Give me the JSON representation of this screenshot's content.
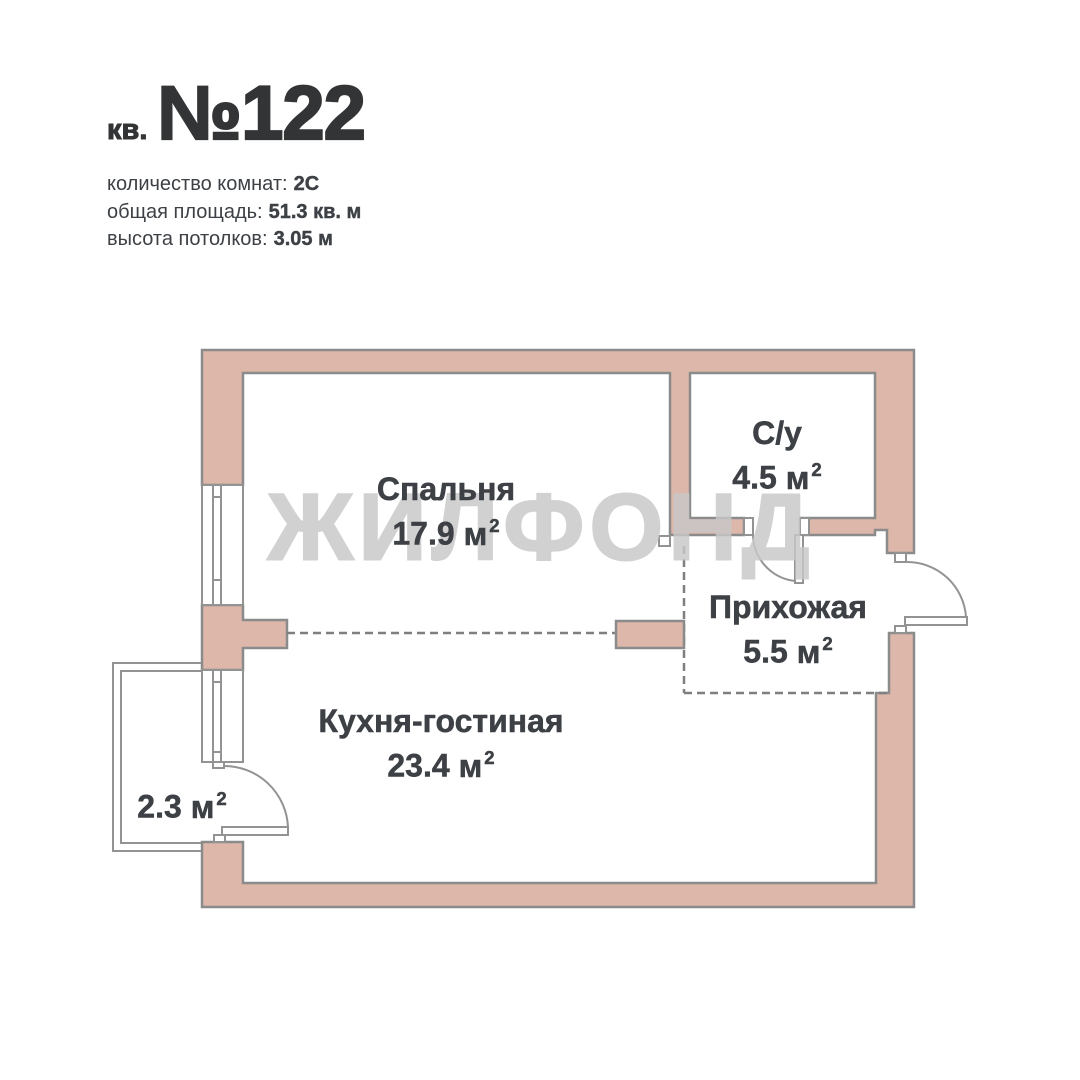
{
  "header": {
    "apt_label": "кв.",
    "apt_number": "№122",
    "details": [
      {
        "label": "количество комнат:",
        "value": "2С"
      },
      {
        "label": "общая площадь:",
        "value": "51.3 кв. м"
      },
      {
        "label": "высота потолков:",
        "value": "3.05 м"
      }
    ]
  },
  "watermark": "ЖИЛФОНД",
  "rooms": {
    "bedroom": {
      "name": "Спальня",
      "area": "17.9",
      "unit": "м",
      "sup": "2"
    },
    "bathroom": {
      "name": "С/у",
      "area": "4.5",
      "unit": "м",
      "sup": "2"
    },
    "hallway": {
      "name": "Прихожая",
      "area": "5.5",
      "unit": "м",
      "sup": "2"
    },
    "kitchen_living": {
      "name": "Кухня-гостиная",
      "area": "23.4",
      "unit": "м",
      "sup": "2"
    },
    "balcony": {
      "area": "2.3",
      "unit": "м",
      "sup": "2"
    }
  },
  "colors": {
    "wall_fill": "#dcb7aa",
    "wall_stroke": "#8b8b8b",
    "thin_stroke": "#939393",
    "dash_stroke": "#7f7f7f",
    "text": "#3d4145",
    "title_text": "#323436",
    "watermark": "#c8c8c8"
  }
}
